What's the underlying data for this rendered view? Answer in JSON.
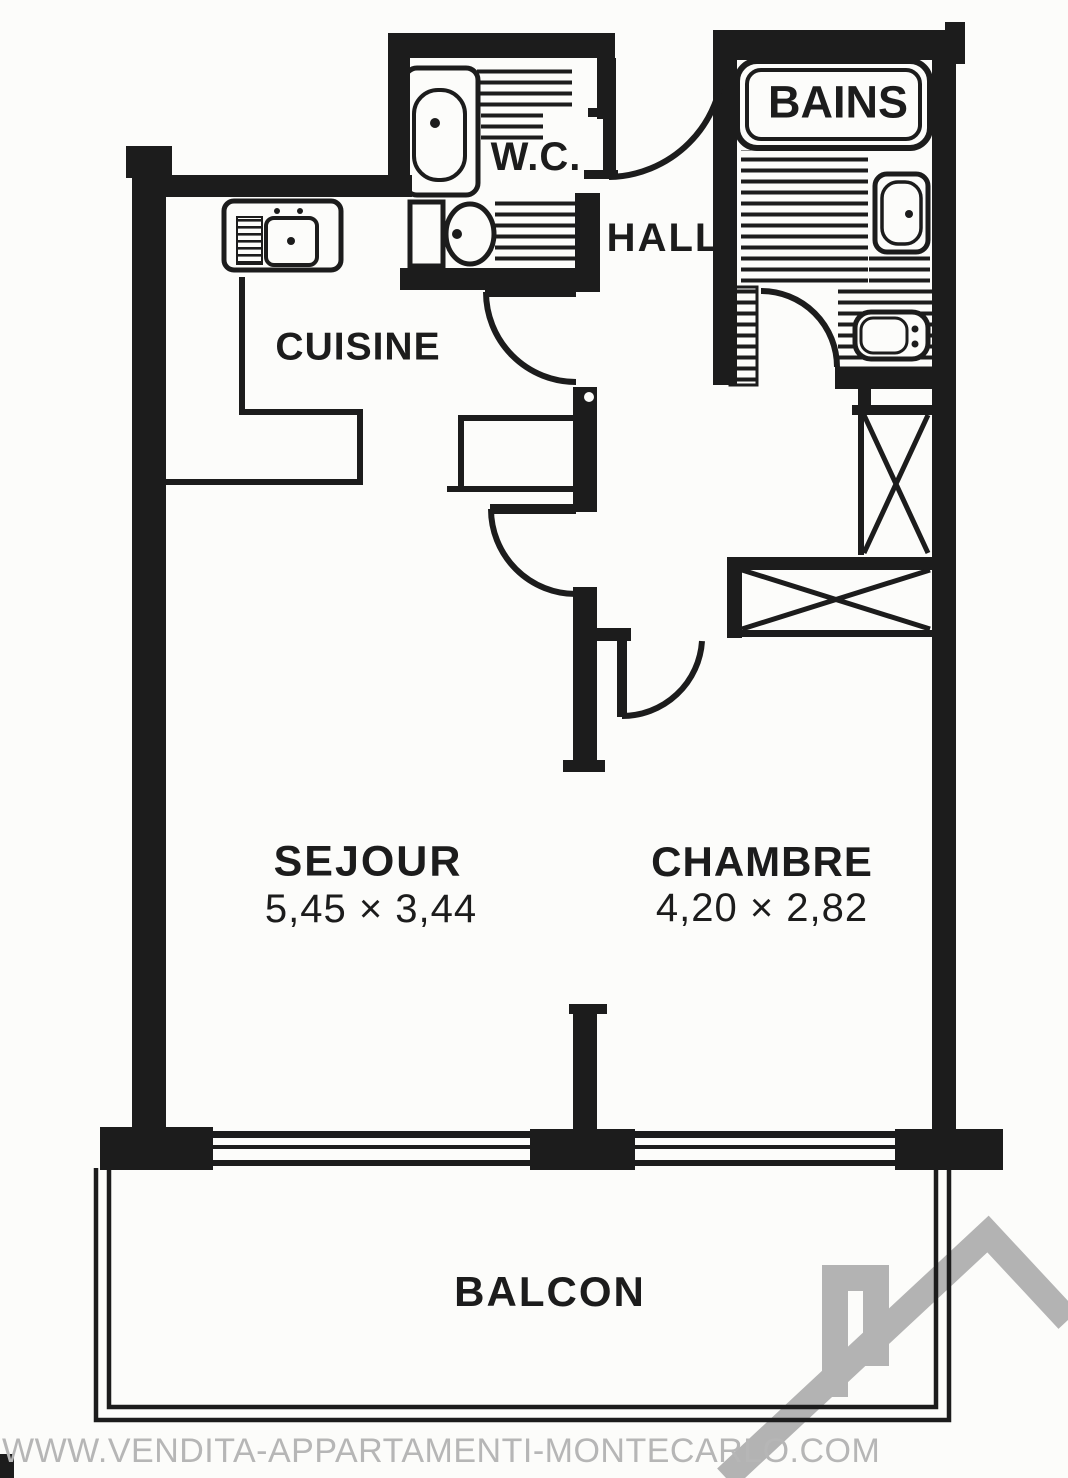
{
  "plan": {
    "rooms": {
      "wc": {
        "label": "W.C."
      },
      "hall": {
        "label": "HALL"
      },
      "bains": {
        "label": "BAINS"
      },
      "cuisine": {
        "label": "CUISINE"
      },
      "sejour": {
        "label": "SEJOUR",
        "dimensions": "5,45 × 3,44"
      },
      "chambre": {
        "label": "CHAMBRE",
        "dimensions": "4,20 × 2,82"
      },
      "balcon": {
        "label": "BALCON"
      }
    },
    "watermark": "WWW.VENDITA-APPARTAMENTI-MONTECARLO.COM",
    "colors": {
      "ink": "#1c1c1c",
      "paper": "#fcfcfa",
      "watermark_gray": "#b6b6b6",
      "logo_gray": "#b3b3b3"
    }
  }
}
